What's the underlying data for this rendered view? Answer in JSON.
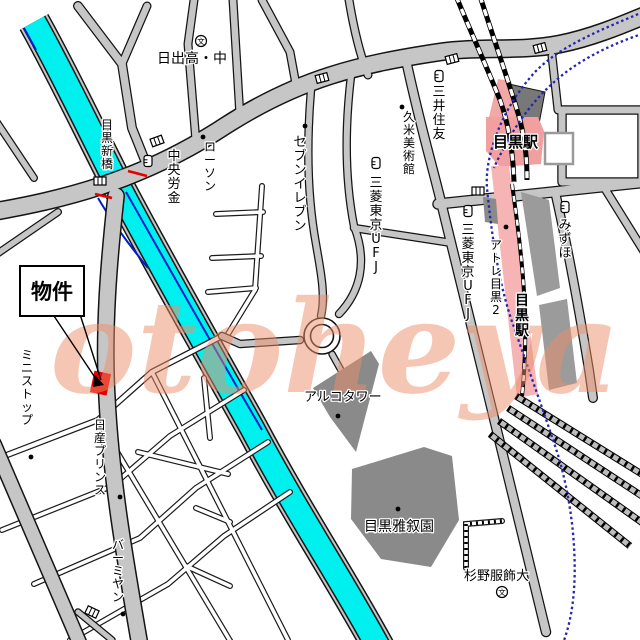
{
  "map": {
    "title": "目黒駅周辺地図",
    "watermark": {
      "text": "otoheya",
      "color": "#EE8F6B"
    },
    "colors": {
      "river": "#00F0F0",
      "road_fill": "#C6C6C6",
      "road_casing": "#141414",
      "station_pink": "#F19F9F",
      "platform_pink": "#F6B4B4",
      "building_gray": "#8A8A8A",
      "property_red": "#E60000",
      "subway_blue": "#2525B5",
      "river_edge_navy": "#0020CC"
    },
    "property": {
      "label": "物件"
    },
    "labels": [
      {
        "id": "hinode-school",
        "text": "日出高・中",
        "x": 157,
        "y": 63,
        "size": 14
      },
      {
        "id": "lawson",
        "text": "ローソン",
        "x": 210,
        "y": 151,
        "size": 12,
        "vertical": true
      },
      {
        "id": "chuo-rokin",
        "text": "中央労金",
        "x": 174,
        "y": 160,
        "size": 13,
        "vertical": true
      },
      {
        "id": "seven-eleven",
        "text": "セブンイレブン",
        "x": 300,
        "y": 146,
        "size": 13,
        "vertical": true
      },
      {
        "id": "mitsubishi-ufj-west",
        "text": "三菱東京UFJ",
        "x": 376,
        "y": 187,
        "size": 13,
        "vertical": true
      },
      {
        "id": "mitsui-sumitomo",
        "text": "三井住友",
        "x": 439,
        "y": 96,
        "size": 13,
        "vertical": true
      },
      {
        "id": "kume-museum",
        "text": "久米美術館",
        "x": 409,
        "y": 121,
        "size": 12,
        "vertical": true
      },
      {
        "id": "meguro-station-main",
        "text": "目黒駅",
        "x": 493,
        "y": 147,
        "size": 15,
        "bold": true
      },
      {
        "id": "mizuho",
        "text": "みずほ",
        "x": 565,
        "y": 229,
        "size": 13,
        "vertical": true
      },
      {
        "id": "mitsubishi-ufj-east",
        "text": "三菱東京UFJ",
        "x": 468,
        "y": 234,
        "size": 13,
        "vertical": true
      },
      {
        "id": "atre-meguro-2",
        "text": "アトレ目黒2",
        "x": 496,
        "y": 249,
        "size": 12,
        "vertical": true
      },
      {
        "id": "meguro-station-south",
        "text": "目黒駅",
        "x": 522,
        "y": 305,
        "size": 14,
        "bold": true,
        "vertical": true
      },
      {
        "id": "arco-tower",
        "text": "アルコタワー",
        "x": 304,
        "y": 401,
        "size": 13
      },
      {
        "id": "meguro-gajoen",
        "text": "目黒雅叙園",
        "x": 364,
        "y": 531,
        "size": 14
      },
      {
        "id": "sugino-fashion-college",
        "text": "杉野服飾大",
        "x": 464,
        "y": 580,
        "size": 13
      },
      {
        "id": "meguro-shinbashi",
        "text": "目黒新橋",
        "x": 107,
        "y": 129,
        "size": 12,
        "vertical": true
      },
      {
        "id": "nissan-prince",
        "text": "日産プリンス",
        "x": 100,
        "y": 429,
        "size": 12,
        "vertical": true
      },
      {
        "id": "ministop",
        "text": "ミニストップ",
        "x": 27,
        "y": 359,
        "size": 12,
        "vertical": true
      },
      {
        "id": "bamiyan",
        "text": "バーミヤン",
        "x": 118,
        "y": 549,
        "size": 12,
        "vertical": true
      }
    ],
    "icons": [
      {
        "type": "school",
        "x": 201,
        "y": 41
      },
      {
        "type": "school",
        "x": 502,
        "y": 592
      },
      {
        "type": "bank",
        "x": 148,
        "y": 161
      },
      {
        "type": "bank",
        "x": 376,
        "y": 163
      },
      {
        "type": "bank",
        "x": 439,
        "y": 76
      },
      {
        "type": "bank",
        "x": 565,
        "y": 207
      },
      {
        "type": "bank",
        "x": 468,
        "y": 211
      },
      {
        "type": "poi-dot",
        "x": 203,
        "y": 137
      },
      {
        "type": "poi-dot",
        "x": 305,
        "y": 126
      },
      {
        "type": "poi-dot",
        "x": 402,
        "y": 107
      },
      {
        "type": "poi-dot",
        "x": 506,
        "y": 227
      },
      {
        "type": "poi-dot",
        "x": 338,
        "y": 416
      },
      {
        "type": "poi-dot",
        "x": 398,
        "y": 509
      },
      {
        "type": "poi-dot",
        "x": 123,
        "y": 614
      },
      {
        "type": "poi-dot",
        "x": 120,
        "y": 497
      },
      {
        "type": "poi-dot",
        "x": 31,
        "y": 457
      },
      {
        "type": "signal",
        "x": 157,
        "y": 141,
        "rot": -20
      },
      {
        "type": "signal",
        "x": 100,
        "y": 181
      },
      {
        "type": "signal",
        "x": 322,
        "y": 78,
        "rot": -15
      },
      {
        "type": "signal",
        "x": 452,
        "y": 59,
        "rot": -15
      },
      {
        "type": "signal",
        "x": 540,
        "y": 48,
        "rot": -15
      },
      {
        "type": "signal",
        "x": 478,
        "y": 191
      },
      {
        "type": "signal",
        "x": 92,
        "y": 612,
        "rot": 25
      }
    ]
  }
}
